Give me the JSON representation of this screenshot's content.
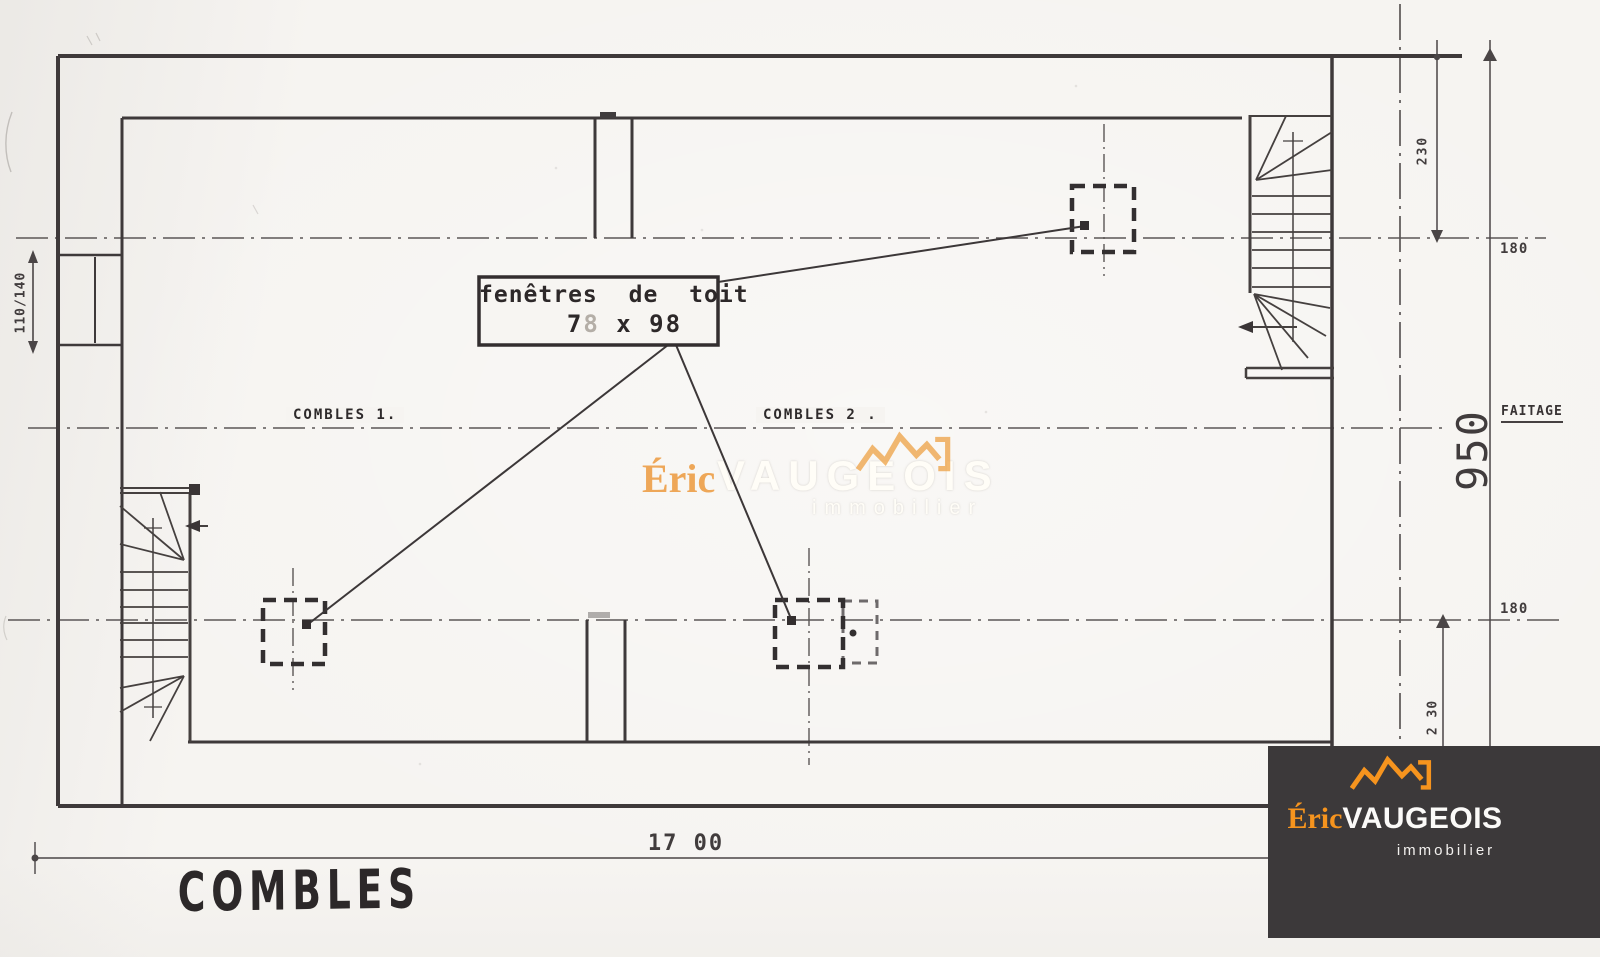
{
  "plan": {
    "title": "COMBLES",
    "rooms": {
      "combles1": "COMBLES 1.",
      "combles2": "COMBLES 2 ."
    },
    "note": {
      "line1": "fenêtres de toit",
      "size_first": "7",
      "size_faded": "8",
      "size_rest": " x 98"
    },
    "dims": {
      "left_window": "110/140",
      "overall_width": "17 00",
      "overall_depth": "950",
      "top_230": "230",
      "top_180": "180",
      "bottom_180": "180",
      "bottom_230": "2 30",
      "ridge_label": "FAITAGE"
    }
  },
  "watermark": {
    "first": "Éric",
    "last": "VAUGEOIS",
    "tagline": "immobilier"
  },
  "logo": {
    "first": "Éric",
    "last": "VAUGEOIS",
    "tagline": "immobilier"
  },
  "colors": {
    "paper": "#f6f4f1",
    "ink": "#383334",
    "orange": "#f6941e",
    "watermark_orange": "#eea14b",
    "logo_background": "#3c393a"
  }
}
